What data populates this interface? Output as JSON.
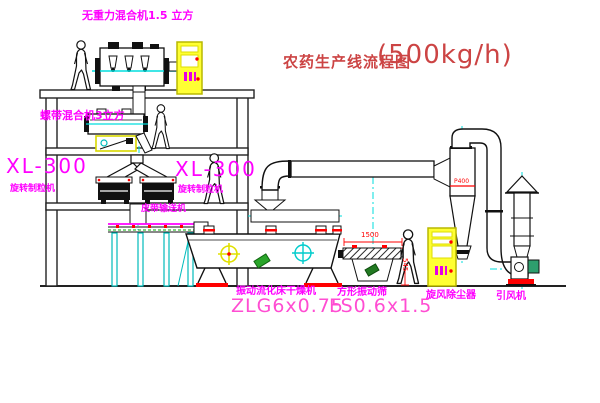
{
  "title": {
    "name": "农药生产线流程图",
    "capacity": "(500kg/h)"
  },
  "equipment": {
    "gravity_mixer": {
      "label": "无重力混合机1.5 立方"
    },
    "ribbon_mixer": {
      "label": "螺带混合机3立方"
    },
    "granulator_left": {
      "model": "XL-300",
      "name": "旋转制粒机"
    },
    "granulator_right": {
      "model": "XL-300",
      "name": "旋转制粒机"
    },
    "belt_conveyor": {
      "label": "皮带输送机"
    },
    "fluid_bed_dryer": {
      "name": "振动流化床干燥机",
      "model": "ZLG6x0.75"
    },
    "vibrating_screen": {
      "name": "方形振动筛",
      "model": "FS0.6x1.5",
      "dim_length": "1500",
      "dim_height": "545"
    },
    "cyclone": {
      "label": "旋风除尘器",
      "tag": "P400"
    },
    "fan": {
      "label": "引风机"
    }
  },
  "colors": {
    "label_magenta": "#ff00ff",
    "model_pink": "#ff4dd2",
    "title_red": "#cc4444",
    "dimension_red": "#ff0000",
    "centerline_cyan": "#00dddd",
    "cabinet_yellow": "#ffff33",
    "green_accent": "#2aa52a",
    "line_black": "#111111"
  }
}
